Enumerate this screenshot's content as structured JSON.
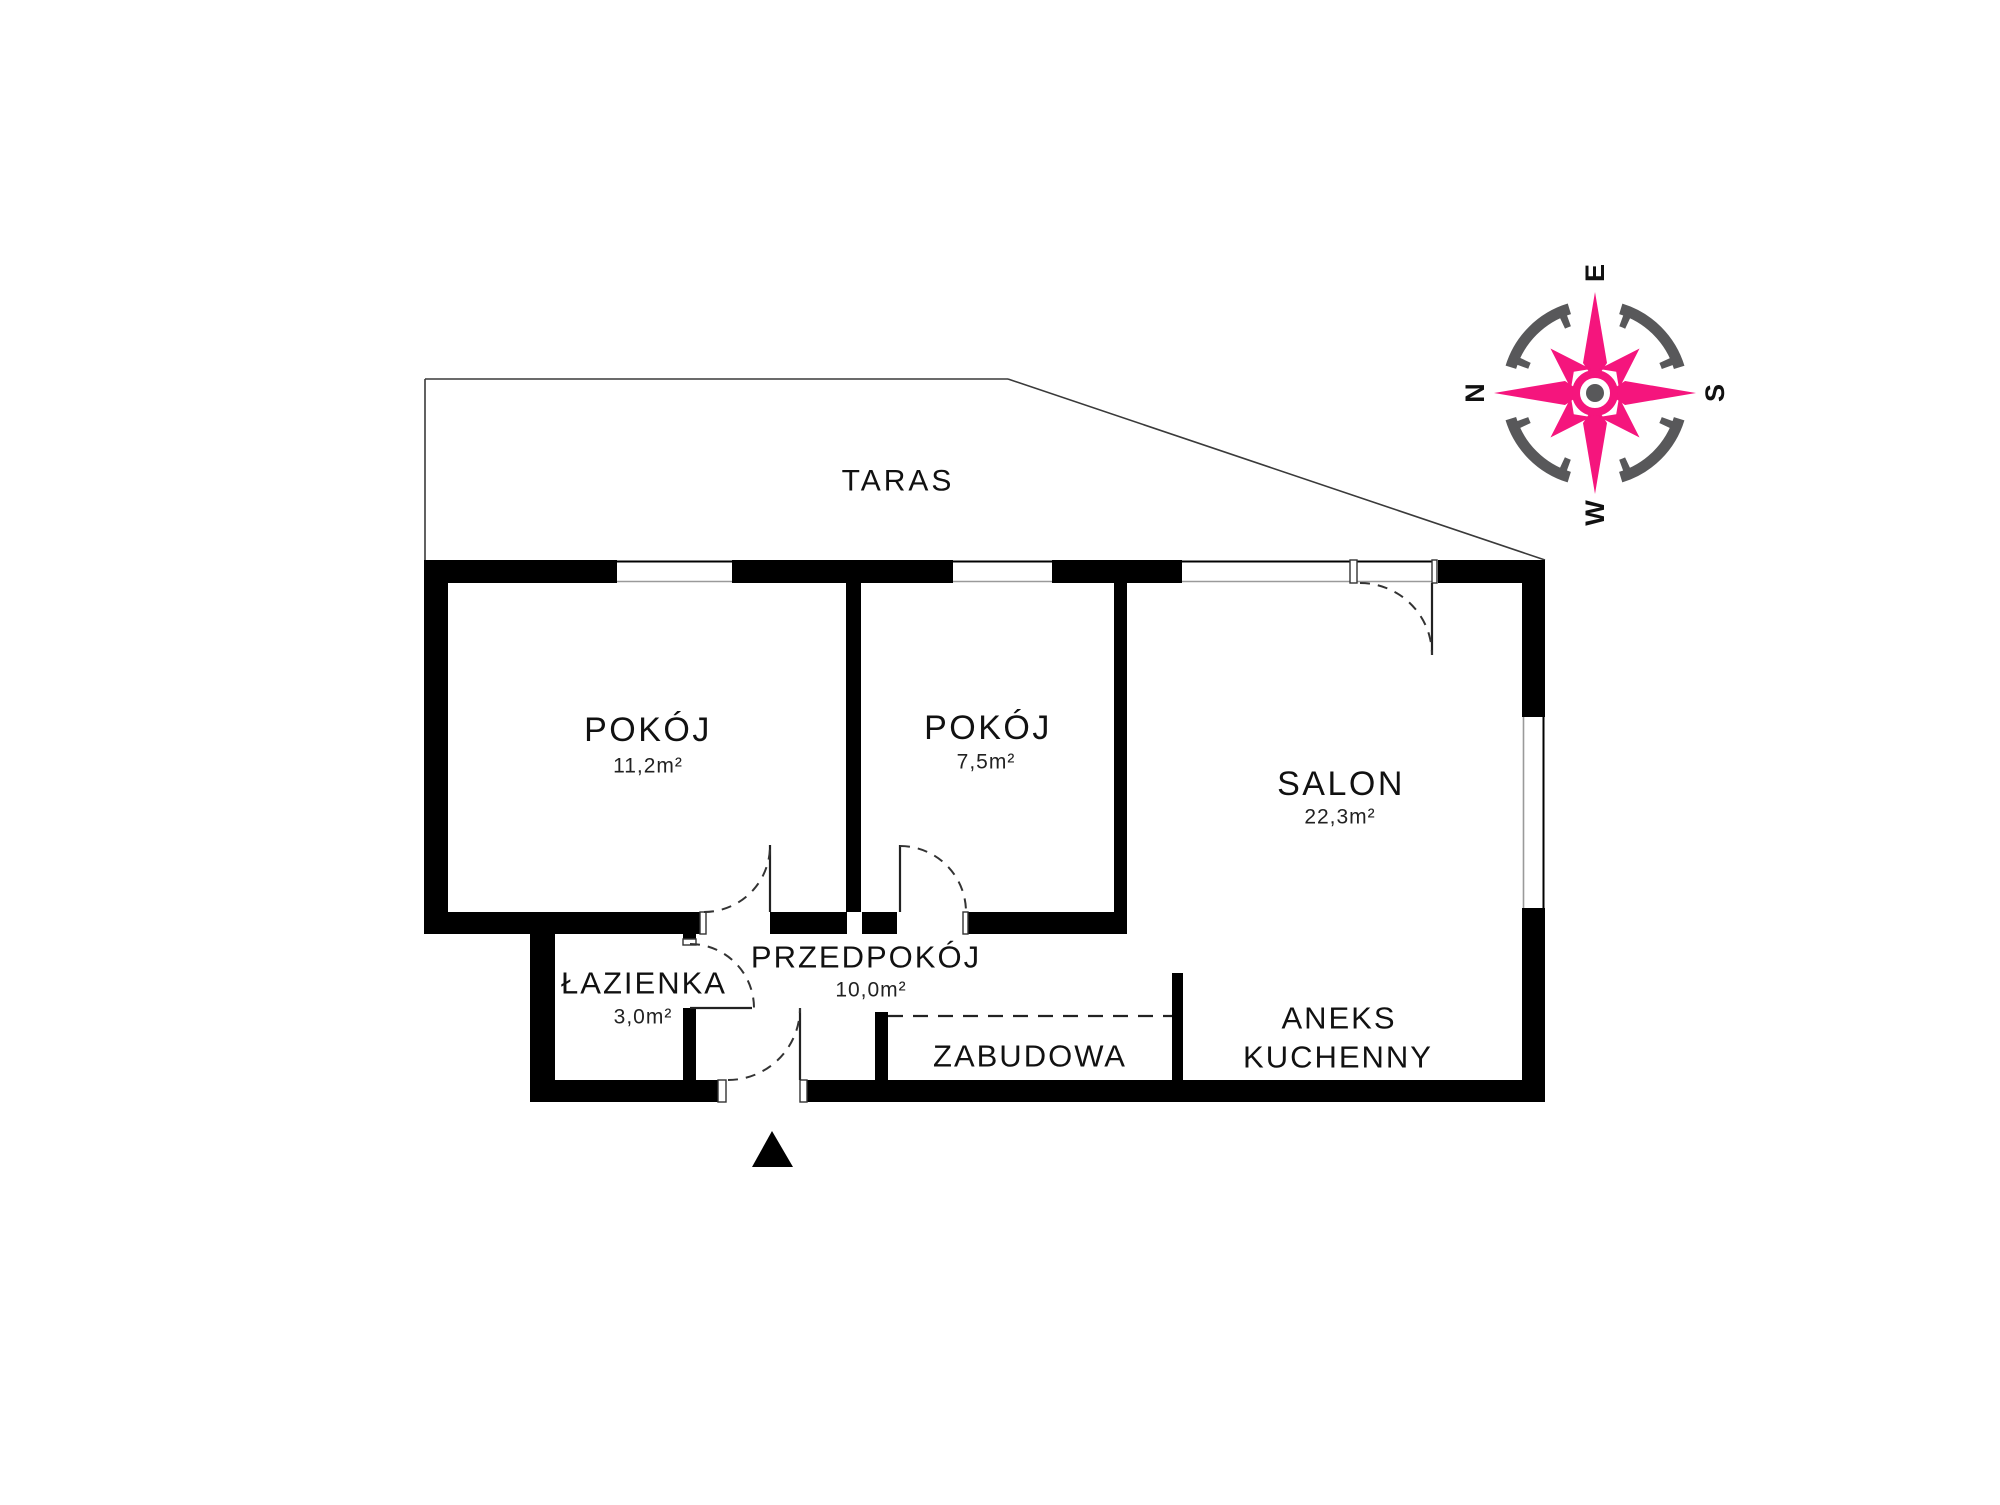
{
  "colors": {
    "accent": "#F5157D",
    "compass_gray": "#58585A",
    "wall": "#000000"
  },
  "floor_plan": {
    "terrace": {
      "label": "TARAS"
    },
    "rooms": {
      "pokoj1": {
        "label": "POKÓJ",
        "area": "11,2m²"
      },
      "pokoj2": {
        "label": "POKÓJ",
        "area": "7,5m²"
      },
      "salon": {
        "label": "SALON",
        "area": "22,3m²"
      },
      "lazienka": {
        "label": "ŁAZIENKA",
        "area": "3,0m²"
      },
      "przedpokoj": {
        "label": "PRZEDPOKÓJ",
        "area": "10,0m²"
      },
      "zabudowa": {
        "label": "ZABUDOWA"
      },
      "aneks_kuchenny": {
        "label_line1": "ANEKS",
        "label_line2": "KUCHENNY"
      }
    }
  },
  "compass": {
    "north": "N",
    "east": "E",
    "south": "S",
    "west": "W"
  }
}
